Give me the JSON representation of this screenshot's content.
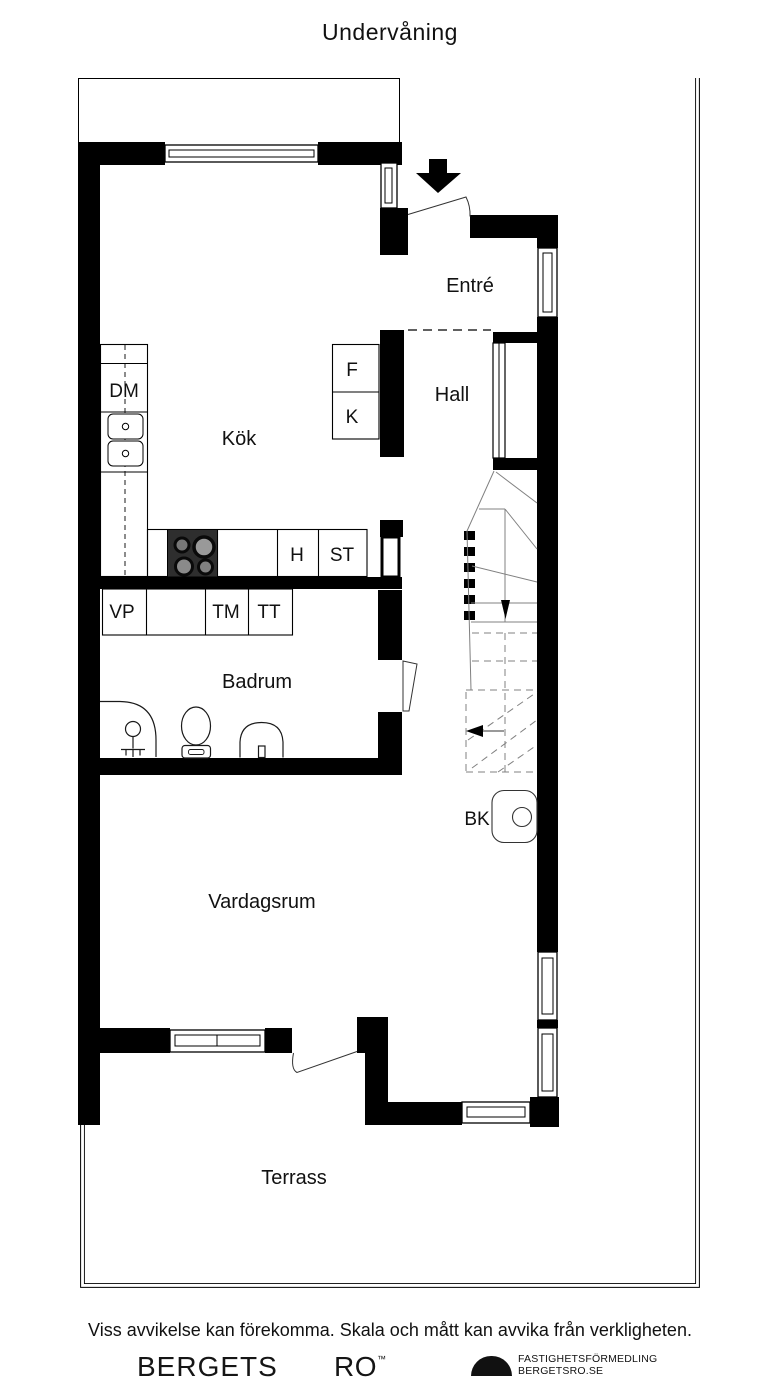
{
  "title": "Undervåning",
  "rooms": {
    "entre": "Entré",
    "hall": "Hall",
    "kok": "Kök",
    "badrum": "Badrum",
    "vardagsrum": "Vardagsrum",
    "terrass": "Terrass"
  },
  "fixtures": {
    "dm": "DM",
    "f": "F",
    "k": "K",
    "h": "H",
    "st": "ST",
    "vp": "VP",
    "tm": "TM",
    "tt": "TT",
    "bk": "BK"
  },
  "footer": {
    "disclaimer": "Viss avvikelse kan förekomma. Skala och mått kan avvika från verkligheten."
  },
  "brand": {
    "name_left": "BERGETS",
    "name_right": "RO",
    "trademark": "™",
    "tagline_line1": "FASTIGHETSFÖRMEDLING",
    "tagline_line2": "BERGETSRO.SE"
  },
  "colors": {
    "wall": "#000000",
    "background": "#ffffff",
    "stove": "#2e2e2e"
  }
}
